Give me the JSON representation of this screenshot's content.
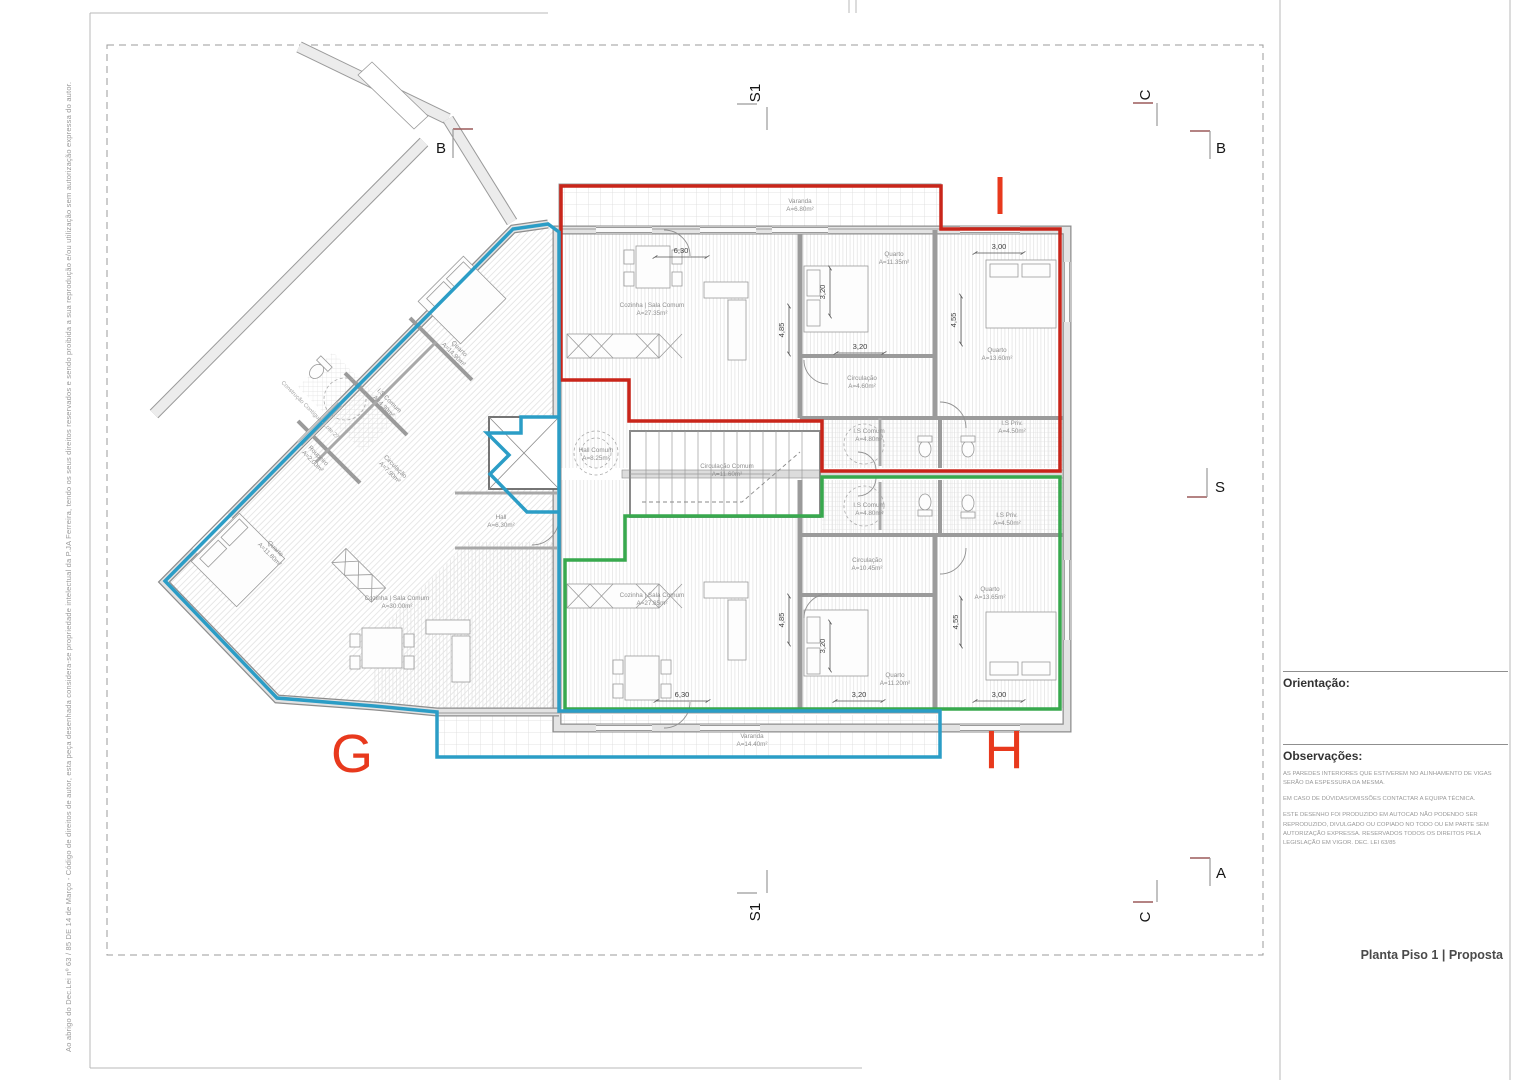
{
  "sheet": {
    "title": "Planta Piso 1 | Proposta",
    "orientation_label": "Orientação:",
    "observations_label": "Observações:",
    "note1": "AS PAREDES INTERIORES QUE ESTIVEREM NO ALINHAMENTO DE VIGAS SERÃO DA ESPESSURA DA MESMA.",
    "note2": "EM CASO DE DÚVIDAS/OMISSÕES CONTACTAR A EQUIPA TÉCNICA.",
    "note3": "ESTE DESENHO FOI PRODUZIDO EM AUTOCAD NÃO PODENDO SER REPRODUZIDO, DIVULGADO OU COPIADO NO TODO OU EM PARTE SEM AUTORIZAÇÃO EXPRESSA. RESERVADOS TODOS OS DIREITOS PELA LEGISLAÇÃO EM VIGOR. DEC. LEI 63/85",
    "copyright": "Ao abrigo do Dec.Lei nº 63 / 85 DE 14 de Março - Código de direitos de autor, esta peça desenhada considera-se propriedade intelectual da P.JA Ferreira, tendo os seus direitos reservados e sendo proibida a sua reprodução e/ou utilização sem autorização expressa do autor."
  },
  "units": {
    "g": "G",
    "h": "H",
    "i": "I"
  },
  "unit_colors": {
    "g": "#2b9dc6",
    "h": "#38a94e",
    "i": "#c9251a",
    "letters": "#e8391d"
  },
  "context_label": "Construção Contígua - Lote 27",
  "section_marks": {
    "b_left": "B",
    "b_right": "B",
    "c_top": "C",
    "c_bottom": "C",
    "s_right": "S",
    "a_right": "A",
    "s1_top": "S1",
    "s1_bottom": "S1"
  },
  "rooms": [
    {
      "name": "Varanda",
      "area": "A=6.80m²"
    },
    {
      "name": "Cozinha | Sala Comum",
      "area": "A=27.35m²"
    },
    {
      "name": "Quarto",
      "area": "A=11.35m²"
    },
    {
      "name": "Quarto",
      "area": "A=13.60m²"
    },
    {
      "name": "Circulação",
      "area": "A=4.60m²"
    },
    {
      "name": "I.S Comum",
      "area": "A=4.80m²"
    },
    {
      "name": "I.S Priv.",
      "area": "A=4.50m²"
    },
    {
      "name": "Hall Comum",
      "area": "A=8.25m²"
    },
    {
      "name": "Circulação Comum",
      "area": "A=11.60m²"
    },
    {
      "name": "Hall",
      "area": "A=6.30m²"
    },
    {
      "name": "I.S Comum",
      "area": "A=4.80m²"
    },
    {
      "name": "I.S Priv.",
      "area": "A=4.50m²"
    },
    {
      "name": "Circulação",
      "area": "A=10.45m²"
    },
    {
      "name": "Quarto",
      "area": "A=13.65m²"
    },
    {
      "name": "Quarto",
      "area": "A=11.20m²"
    },
    {
      "name": "Cozinha | Sala Comum",
      "area": "A=27.85m²"
    },
    {
      "name": "Varanda",
      "area": "A=14.40m²"
    },
    {
      "name": "Quarto",
      "area": "A=14.90m²"
    },
    {
      "name": "I.S Comum",
      "area": "A=4.30m²"
    },
    {
      "name": "Roupeiro",
      "area": "A=2.00m²"
    },
    {
      "name": "Circulação",
      "area": "A=7.90m²"
    },
    {
      "name": "Quarto",
      "area": "A=11.80m²"
    },
    {
      "name": "Cozinha | Sala Comum",
      "area": "A=30.00m²"
    }
  ],
  "dims": [
    "6,30",
    "4,85",
    "3,20",
    "3,20",
    "3,00",
    "4,55",
    "6,30",
    "4,85",
    "3,20",
    "3,20",
    "3,00",
    "4,55"
  ]
}
